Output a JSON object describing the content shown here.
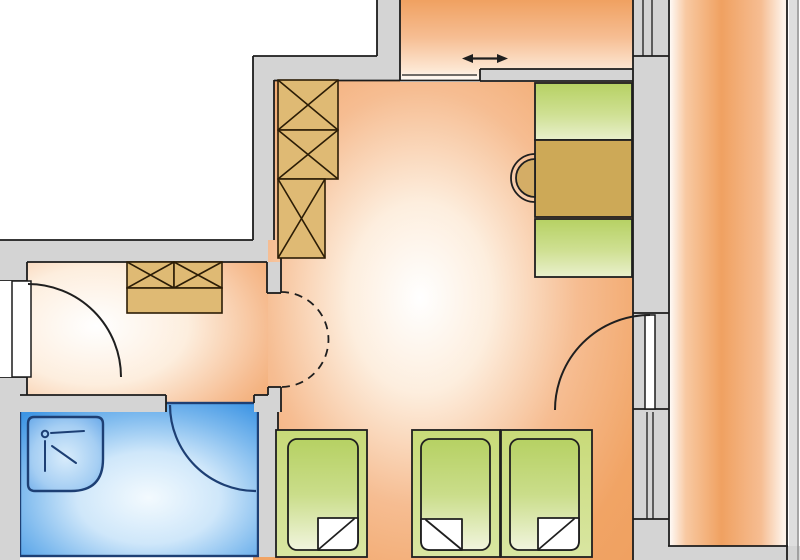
{
  "meta": {
    "title": "Apartment floor plan",
    "image_type": "architectural floor plan, top-down view, no text labels",
    "canvas": {
      "width": 800,
      "height": 560
    }
  },
  "colors": {
    "white": "#ffffff",
    "orange_deep": "#f0a161",
    "orange_mid": "#f6bd92",
    "orange_pale": "#fdeede",
    "wall_fill": "#d4d4d4",
    "wall_line": "#1c1c1c",
    "gray_light": "#dedede",
    "tan": "#dfba74",
    "tan_line": "#2c1d06",
    "desk_brown": "#cda957",
    "chair": "#d4ad66",
    "green_dark": "#b6d163",
    "green_mid": "#cfe093",
    "green_pale": "#e9f0cd",
    "blue_deep": "#3e95e4",
    "navy": "#1d3f74",
    "leaf_white": "#ffffff"
  },
  "rooms": [
    {
      "id": "hall-top",
      "label": "entry hall (top center)",
      "floor": "orange gradient"
    },
    {
      "id": "main-room",
      "label": "main room (center)",
      "floor": "orange gradient"
    },
    {
      "id": "vestibule",
      "label": "small room (left)",
      "floor": "orange gradient"
    },
    {
      "id": "bathroom",
      "label": "bathroom (bottom left)",
      "floor": "blue gradient"
    },
    {
      "id": "balcony",
      "label": "balcony strip (right)",
      "floor": "orange gradient"
    }
  ],
  "doors": [
    {
      "id": "entrance-door",
      "type": "swing door with quarter-circle arc",
      "location": "left wall of vestibule"
    },
    {
      "id": "sliding-door",
      "type": "sliding door",
      "symbol": "double-headed arrow",
      "location": "between hall and main room"
    },
    {
      "id": "bathroom-door",
      "type": "swing door arc",
      "location": "bathroom top wall"
    },
    {
      "id": "balcony-door",
      "type": "swing door with leaf and arc",
      "location": "right wall of main room"
    },
    {
      "id": "arch-opening",
      "type": "dashed half-circle opening",
      "location": "between vestibule and main room"
    }
  ],
  "windows": [
    {
      "id": "window-top-right",
      "location": "wall between hall and balcony, double glazing lines"
    },
    {
      "id": "window-mid-right",
      "location": "wall between main room and balcony, below balcony door"
    }
  ],
  "furniture": [
    {
      "id": "wardrobe",
      "symbol": "three stacked boxes with X cross",
      "location": "main room, upper left"
    },
    {
      "id": "cabinet",
      "symbol": "two X-crossed boxes on a base",
      "location": "vestibule, top"
    },
    {
      "id": "desk",
      "panels": [
        "green shelf",
        "brown desktop",
        "green shelf"
      ],
      "location": "main room, upper right"
    },
    {
      "id": "chair",
      "type": "half-round chair at desk",
      "location": "left of desk"
    },
    {
      "id": "shower",
      "symbol": "shower tray with shower-head icon",
      "location": "bathroom, top left"
    },
    {
      "id": "bed-1",
      "symbol": "bed with folded blanket corner (fold bottom-right)"
    },
    {
      "id": "bed-2",
      "symbol": "bed with folded blanket corner (fold bottom-left)"
    },
    {
      "id": "bed-3",
      "symbol": "bed with folded blanket corner (fold bottom-right)"
    }
  ],
  "symbols": [
    {
      "id": "sliding-direction-arrow",
      "glyph": "↔"
    }
  ]
}
